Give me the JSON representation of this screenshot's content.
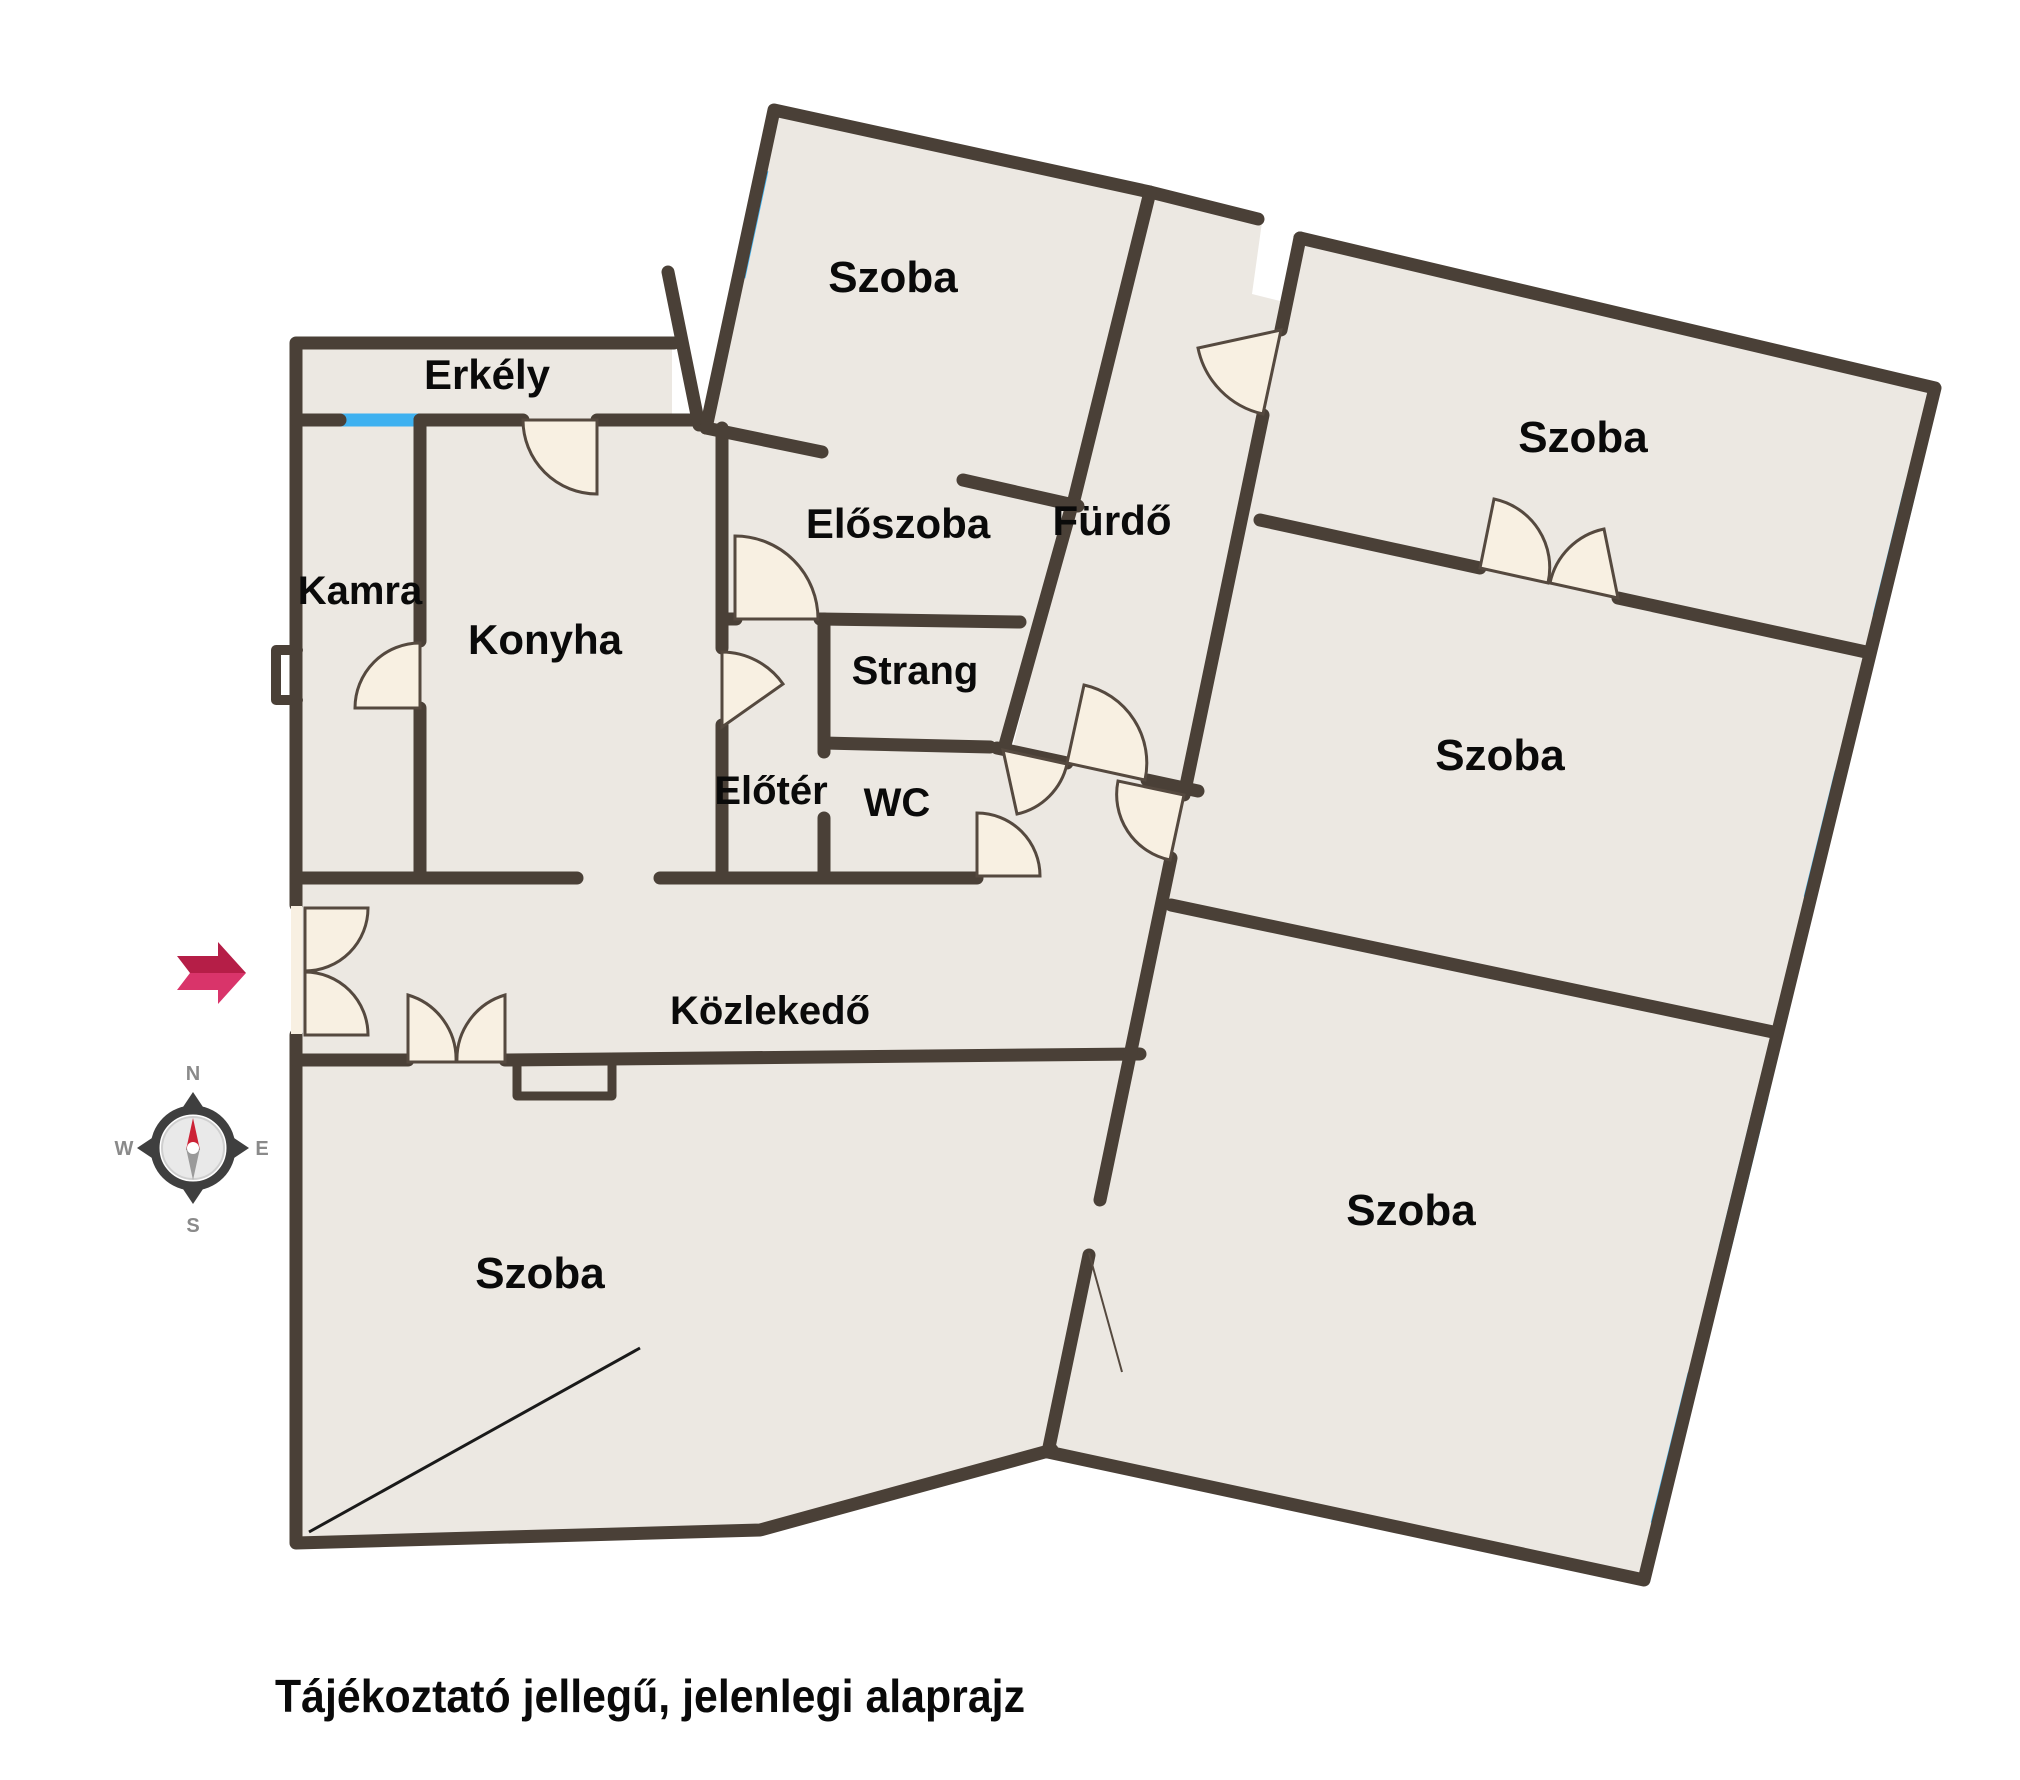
{
  "caption": {
    "text": "Tájékoztató jellegű, jelenlegi alaprajz"
  },
  "rooms": [
    {
      "id": "erkely",
      "label": "Erkély"
    },
    {
      "id": "kamra",
      "label": "Kamra"
    },
    {
      "id": "konyha",
      "label": "Konyha"
    },
    {
      "id": "szoba-top",
      "label": "Szoba"
    },
    {
      "id": "eloszoba",
      "label": "Előszoba"
    },
    {
      "id": "furdo",
      "label": "Fürdő"
    },
    {
      "id": "strang",
      "label": "Strang"
    },
    {
      "id": "eloter",
      "label": "Előtér"
    },
    {
      "id": "wc",
      "label": "WC"
    },
    {
      "id": "kozlekedo",
      "label": "Közlekedő"
    },
    {
      "id": "szoba-bottom",
      "label": "Szoba"
    },
    {
      "id": "szoba-right-1",
      "label": "Szoba"
    },
    {
      "id": "szoba-right-2",
      "label": "Szoba"
    },
    {
      "id": "szoba-right-3",
      "label": "Szoba"
    }
  ],
  "compass": {
    "n": "N",
    "e": "E",
    "s": "S",
    "w": "W"
  },
  "icons": [
    "compass-rose-icon",
    "entrance-arrow-icon"
  ],
  "colors": {
    "wall": "#4a4037",
    "floor": "#ece8e2",
    "window": "#3eb1f0",
    "door_leaf": "#f8f0e2",
    "door_stroke": "#55493f",
    "arrow_dark": "#b51e47",
    "arrow_light": "#d9346a",
    "compass_ring": "#3f3f3f",
    "needle_north": "#cc2236",
    "needle_south": "#9a9a9a",
    "text": "#0a0a0a"
  }
}
